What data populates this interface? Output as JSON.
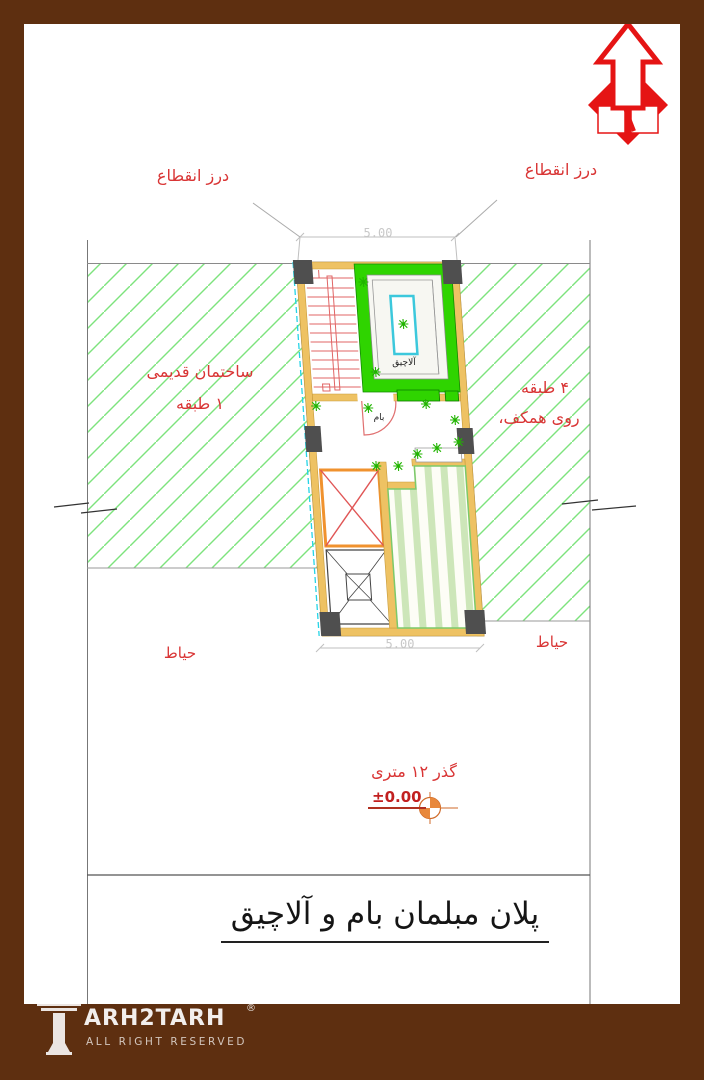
{
  "drawing": {
    "title": "پلان مبلمان بام و آلاچیق",
    "annotations": {
      "expansion_joint_left": "درز انقطاع",
      "expansion_joint_right": "درز انقطاع",
      "old_building_line1": "ساختمان قدیمی",
      "old_building_line2": "۱ طبقه",
      "adjacent_building_line1": "۴ طبقه",
      "adjacent_building_line2": "روی همکف،",
      "yard_left": "حیاط",
      "yard_right": "حیاط",
      "passage": "گذر ۱۲ متری",
      "level": "±0.00"
    },
    "rooms": {
      "gazebo": "آلاچیق",
      "roof": "بام"
    },
    "dimensions": {
      "top": "5.00",
      "bottom": "5.00"
    },
    "icons": {
      "north_arrow": "north-arrow"
    },
    "colors": {
      "frame_brown": "#5e2f10",
      "annotation_red": "#d93535",
      "north_red": "#e51414",
      "hatch_green": "#7de37d",
      "gazebo_green": "#2fd400",
      "wall_tan": "#eec263",
      "column_gray": "#4f4f4f",
      "table_cyan": "#3cc8dc",
      "skylight_orange": "#f0922e",
      "benchmark_orange": "#e8883c"
    }
  },
  "watermark": {
    "brand": "ARH2TARH",
    "registered": "®",
    "tagline": "ALL RIGHT RESERVED"
  }
}
